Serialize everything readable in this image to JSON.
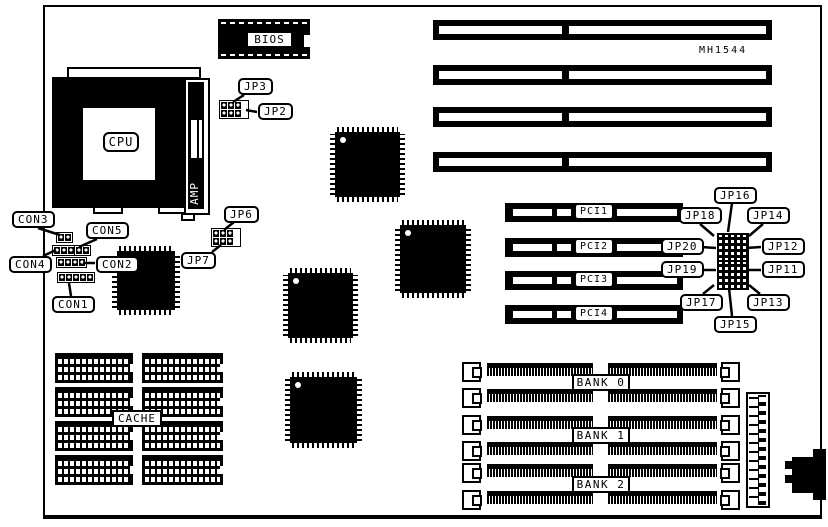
{
  "diagram": {
    "part_number": "MH1544",
    "cpu_label": "CPU",
    "amp_label": "AMP",
    "bios_label": "BIOS",
    "cache_label": "CACHE",
    "connectors": {
      "con1": "CON1",
      "con2": "CON2",
      "con3": "CON3",
      "con4": "CON4",
      "con5": "CON5"
    },
    "jumpers": {
      "jp2": "JP2",
      "jp3": "JP3",
      "jp6": "JP6",
      "jp7": "JP7",
      "jp11": "JP11",
      "jp12": "JP12",
      "jp13": "JP13",
      "jp14": "JP14",
      "jp15": "JP15",
      "jp16": "JP16",
      "jp17": "JP17",
      "jp18": "JP18",
      "jp19": "JP19",
      "jp20": "JP20"
    },
    "slots": {
      "pci": [
        "PCI1",
        "PCI2",
        "PCI3",
        "PCI4"
      ],
      "memory_banks": [
        "BANK 0",
        "BANK 1",
        "BANK 2"
      ]
    }
  }
}
